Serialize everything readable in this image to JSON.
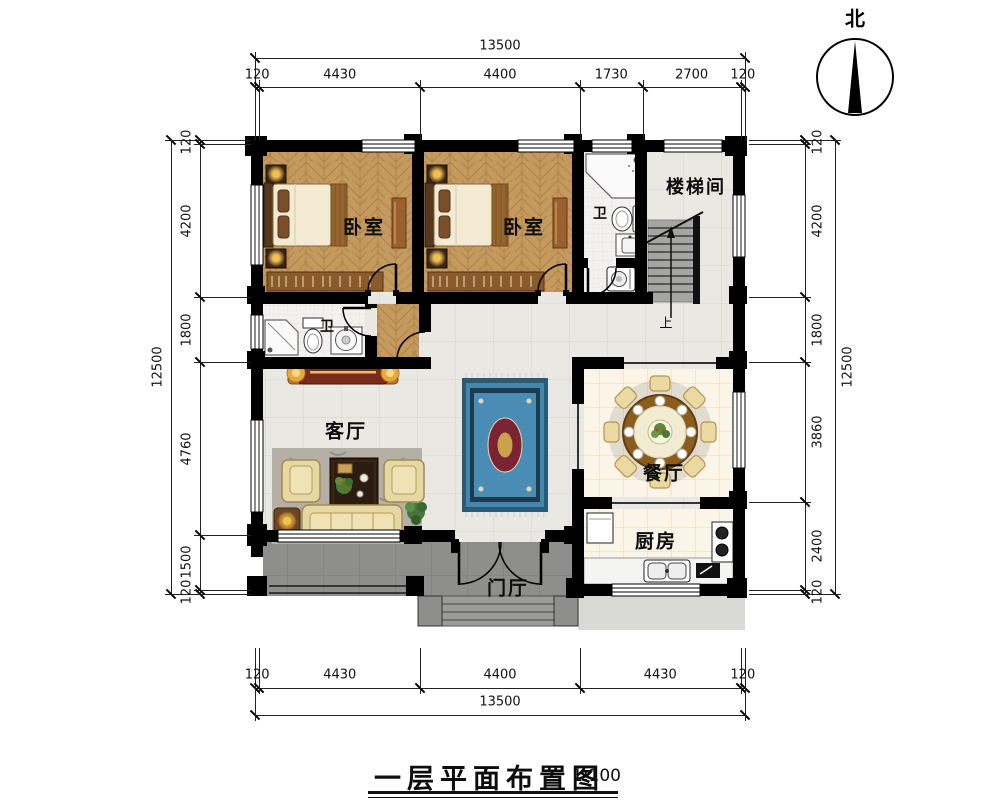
{
  "title": {
    "text": "一层平面布置图",
    "scale": "1:100"
  },
  "north": {
    "label": "北"
  },
  "rooms": {
    "bedroom1": {
      "label": "卧室"
    },
    "bedroom2": {
      "label": "卧室"
    },
    "stairwell": {
      "label": "楼梯间"
    },
    "bathroom_upper": {
      "label": "卫"
    },
    "bathroom_lower": {
      "label": "卫"
    },
    "living_room": {
      "label": "客厅"
    },
    "dining_room": {
      "label": "餐厅"
    },
    "kitchen": {
      "label": "厨房"
    },
    "foyer": {
      "label": "门厅"
    }
  },
  "annotations": {
    "stairs_up": "上"
  },
  "dimensions": {
    "top": {
      "total": "13500",
      "segments": [
        "120",
        "4430",
        "4400",
        "1730",
        "2700",
        "120"
      ]
    },
    "bottom": {
      "total": "13500",
      "segments": [
        "120",
        "4430",
        "4400",
        "4430",
        "120"
      ]
    },
    "left": {
      "total": "12500",
      "segments": [
        "120",
        "4200",
        "1800",
        "4760",
        "1500",
        "120"
      ]
    },
    "right": {
      "total": "12500",
      "segments": [
        "120",
        "4200",
        "1800",
        "3860",
        "2400",
        "120"
      ]
    }
  },
  "colors": {
    "wall": "#000000",
    "wood_floor": "#c49a5f",
    "tile_light": "#eae8e2",
    "tile_cream": "#faf5e8",
    "porch_gray": "#8e8e8c",
    "rug_blue": "#4285ad"
  }
}
